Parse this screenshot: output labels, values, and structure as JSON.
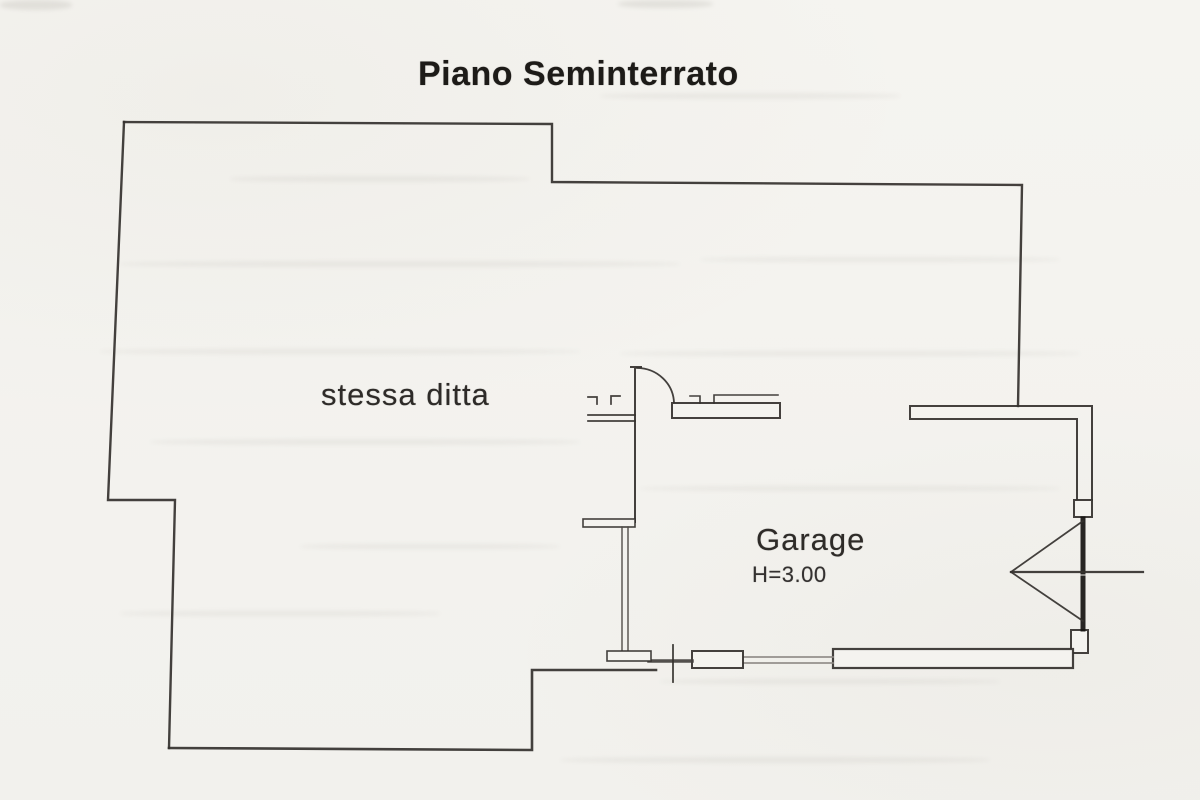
{
  "title": "Piano Seminterrato",
  "plan": {
    "rooms": [
      {
        "id": "stessa-ditta",
        "label": "stessa ditta"
      },
      {
        "id": "garage",
        "label": "Garage",
        "height_annotation": "H=3.00"
      }
    ]
  },
  "colors": {
    "paper": "#f4f3ef",
    "wall_line": "#34312e",
    "garage_door_panel": "#161411",
    "window_line": "#8d8984",
    "title_text": "#1d1b18",
    "label_text": "#2e2b28"
  }
}
